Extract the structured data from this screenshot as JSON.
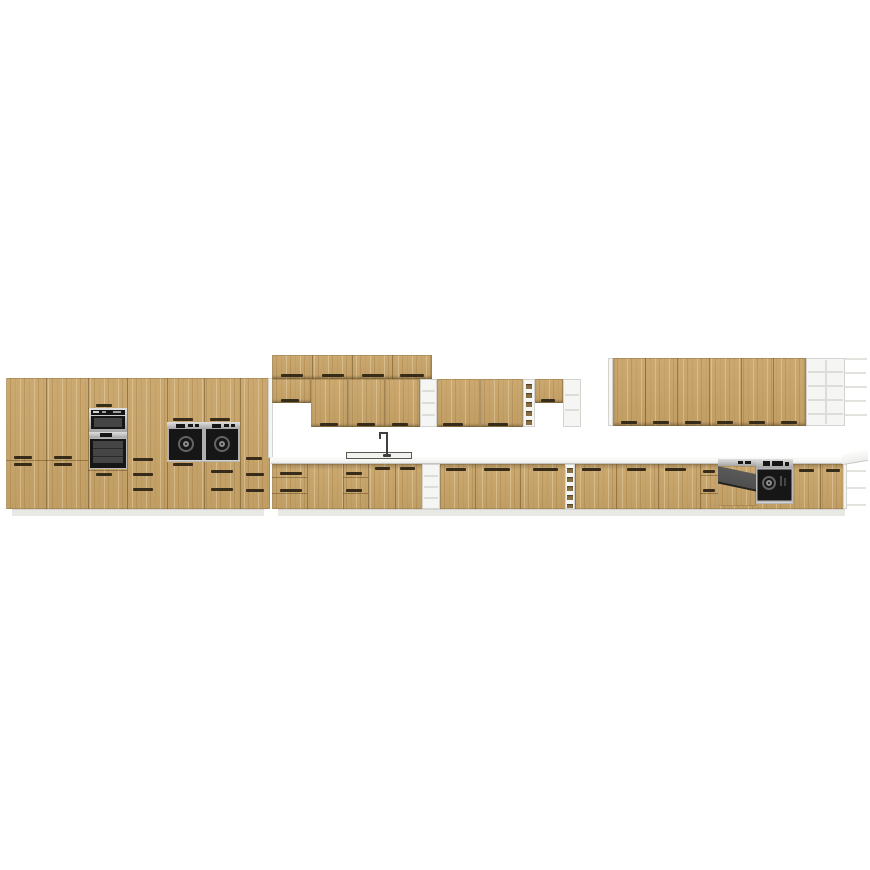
{
  "meta": {
    "description": "3D product render of a long modular kitchen cabinet set on a plain white background, no visible text",
    "image_width": 870,
    "image_height": 870
  },
  "palette": {
    "bg": "#ffffff",
    "wood": "#c8a468",
    "wood-dark": "#8a6f42",
    "grip": "#372c1a",
    "carcass": "#f5f5f3",
    "carcass-line": "#d3d3d0",
    "counter": "#ececea",
    "counter-edge": "#c6c6c3",
    "plinth": "#e8e8e5",
    "steel-light": "#dfdfdf",
    "steel-dark": "#a6a6a6",
    "appl-black": "#161616",
    "appl-inner": "#454545",
    "ring-outer": "#646464",
    "ring-inner": "#8d8d8d",
    "dw-panel": "#4f4f4f",
    "sink-line": "#5a564e"
  },
  "scene": {
    "type": "3d-product-render",
    "subject": "modular kitchen set with oak-effect fronts, white carcasses, integrated appliances",
    "sections": {
      "left_tall_run": [
        "tall-cabinet-2-door",
        "tall-cabinet-2-door",
        "oven-tower-compact-oven-plus-oven",
        "tall-cabinet-with-drawers",
        "tall-oven-housing",
        "tall-oven-housing-with-drawers",
        "tall-cabinet-with-drawers"
      ],
      "upper_middle": [
        "top-box-row-4-doors",
        "short-wall-cabinet",
        "wall-cabinet",
        "wall-cabinet",
        "wall-cabinet",
        "open-shelf-unit",
        "wall-cabinet",
        "wall-cabinet",
        "narrow-open-rack",
        "short-wall-cabinet",
        "open-shelf-unit"
      ],
      "upper_right": [
        "wall-cabinet-run-6-doors",
        "open-shelf-grid-2x5",
        "protruding-side-shelves"
      ],
      "base_run": [
        "drawer-unit",
        "base-door",
        "drawer-unit",
        "sink-cabinet-2-door",
        "open-shelf-unit",
        "base-door",
        "base-door",
        "base-door",
        "bottle-rack",
        "base-door",
        "base-door",
        "base-door",
        "drawer-unit",
        "semi-open-dishwasher",
        "built-in-oven",
        "base-door",
        "base-door",
        "open-end-shelves"
      ],
      "worktop": "light grey worktop with inset sink and mixer tap"
    }
  }
}
